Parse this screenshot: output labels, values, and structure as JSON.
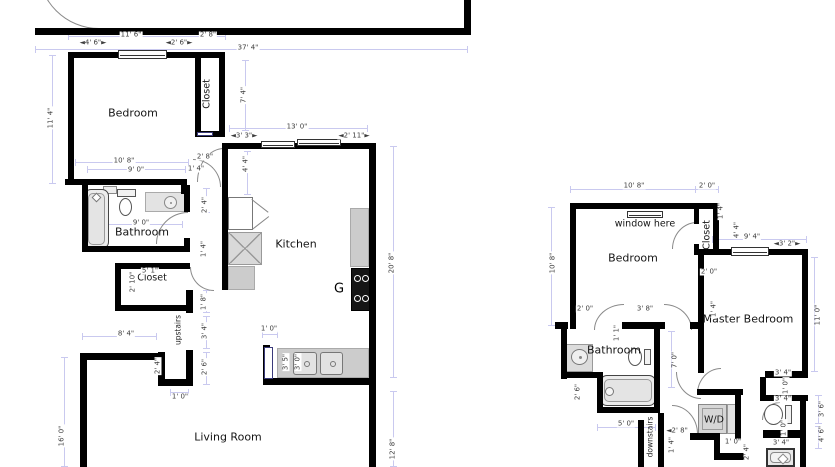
{
  "canvas": {
    "width": 835,
    "height": 467,
    "background": "#ffffff"
  },
  "colors": {
    "wall": "#000000",
    "dimension_line": "#c9c9ef",
    "dimension_text": "#3c3c3c",
    "room_text": "#151515",
    "fixture_fill": "#d9d9d9",
    "fixture_border": "#999999",
    "door_arc": "#8a8a8a",
    "door_jamb": "#3a3a7a"
  },
  "plans": [
    {
      "id": "unit-a-floorplan",
      "walls": [
        [
          35,
          28,
          436,
          7
        ],
        [
          464,
          0,
          7,
          30
        ],
        [
          68,
          52,
          157,
          6
        ],
        [
          68,
          52,
          6,
          133
        ],
        [
          65,
          179,
          122,
          6
        ],
        [
          181,
          185,
          6,
          9
        ],
        [
          195,
          52,
          6,
          85
        ],
        [
          219,
          52,
          6,
          85
        ],
        [
          195,
          131,
          30,
          6
        ],
        [
          82,
          185,
          6,
          67
        ],
        [
          82,
          246,
          108,
          6
        ],
        [
          184,
          185,
          6,
          27
        ],
        [
          184,
          238,
          6,
          14
        ],
        [
          115,
          263,
          75,
          6
        ],
        [
          115,
          263,
          6,
          48
        ],
        [
          115,
          305,
          75,
          6
        ],
        [
          186,
          290,
          7,
          23
        ],
        [
          186,
          350,
          7,
          36
        ],
        [
          158,
          379,
          35,
          7
        ],
        [
          158,
          352,
          7,
          33
        ],
        [
          80,
          353,
          80,
          7
        ],
        [
          80,
          353,
          7,
          114
        ],
        [
          369,
          143,
          7,
          324
        ],
        [
          222,
          143,
          154,
          6
        ],
        [
          222,
          143,
          6,
          147
        ],
        [
          263,
          378,
          113,
          7
        ],
        [
          263,
          345,
          7,
          40
        ]
      ],
      "windows": [
        [
          118,
          50,
          49,
          9
        ],
        [
          261,
          141,
          34,
          7
        ],
        [
          297,
          139,
          44,
          7
        ]
      ],
      "jambs": [
        [
          264,
          347,
          9,
          32
        ],
        [
          197,
          132,
          16,
          4
        ]
      ],
      "arcs": [
        [
          38,
          -32,
          60,
          60,
          "bl"
        ],
        [
          193,
          159,
          27,
          27,
          "tr"
        ],
        [
          197,
          148,
          26,
          33,
          "tl"
        ],
        [
          156,
          212,
          31,
          31,
          "tl"
        ],
        [
          190,
          267,
          23,
          23,
          "bl"
        ]
      ],
      "dimlines": [
        [
          68,
          36,
          225,
          36
        ],
        [
          35,
          49,
          467,
          49
        ],
        [
          52,
          55,
          52,
          183
        ],
        [
          245,
          60,
          245,
          130
        ],
        [
          229,
          128,
          367,
          128
        ],
        [
          247,
          151,
          247,
          194
        ],
        [
          75,
          162,
          188,
          162
        ],
        [
          87,
          169,
          185,
          169
        ],
        [
          393,
          146,
          393,
          377
        ],
        [
          393,
          391,
          393,
          466
        ],
        [
          64,
          357,
          64,
          466
        ],
        [
          82,
          336,
          156,
          336
        ],
        [
          92,
          224,
          182,
          224
        ],
        [
          206,
          188,
          206,
          212
        ],
        [
          206,
          290,
          206,
          312
        ],
        [
          206,
          316,
          206,
          348
        ],
        [
          206,
          352,
          206,
          384
        ],
        [
          161,
          354,
          161,
          382
        ],
        [
          170,
          392,
          188,
          392
        ],
        [
          262,
          334,
          277,
          334
        ]
      ],
      "fixtures": [
        {
          "type": "shelf",
          "x": 103,
          "y": 186,
          "w": 14,
          "h": 8
        },
        {
          "type": "tub-v",
          "x": 84,
          "y": 189,
          "w": 25,
          "h": 60
        },
        {
          "type": "toilet-down",
          "x": 116,
          "y": 189,
          "w": 23,
          "h": 29
        },
        {
          "type": "sink-counter",
          "x": 145,
          "y": 192,
          "w": 41,
          "h": 20
        },
        {
          "type": "fridge",
          "x": 228,
          "y": 197,
          "w": 25,
          "h": 33
        },
        {
          "type": "xbox",
          "x": 228,
          "y": 232,
          "w": 34,
          "h": 33
        },
        {
          "type": "counter",
          "x": 228,
          "y": 266,
          "w": 27,
          "h": 24
        },
        {
          "type": "counter",
          "x": 350,
          "y": 208,
          "w": 19,
          "h": 59
        },
        {
          "type": "stove",
          "x": 351,
          "y": 268,
          "w": 19,
          "h": 43
        },
        {
          "type": "counter",
          "x": 277,
          "y": 348,
          "w": 92,
          "h": 30
        },
        {
          "type": "dsink",
          "x": 293,
          "y": 351,
          "w": 50,
          "h": 25
        }
      ],
      "labels": [
        {
          "t": "Bedroom",
          "x": 133,
          "y": 113,
          "c": "room"
        },
        {
          "t": "Closet",
          "x": 207,
          "y": 94,
          "c": "rsm",
          "v": 1
        },
        {
          "t": "Bathroom",
          "x": 142,
          "y": 232,
          "c": "room"
        },
        {
          "t": "Closet",
          "x": 152,
          "y": 278,
          "c": "rsm"
        },
        {
          "t": "Kitchen",
          "x": 296,
          "y": 244,
          "c": "room"
        },
        {
          "t": "G",
          "x": 339,
          "y": 289,
          "c": "big"
        },
        {
          "t": "upstairs",
          "x": 178,
          "y": 330,
          "c": "tiny",
          "v": 1
        },
        {
          "t": "Living Room",
          "x": 228,
          "y": 437,
          "c": "room"
        },
        {
          "t": "11' 6\"",
          "x": 131,
          "y": 35,
          "c": "dim"
        },
        {
          "t": "2' 8\"",
          "x": 208,
          "y": 35,
          "c": "dim"
        },
        {
          "t": "◄4' 6\"►",
          "x": 93,
          "y": 43,
          "c": "dim"
        },
        {
          "t": "◄2' 6\"►",
          "x": 179,
          "y": 43,
          "c": "dim"
        },
        {
          "t": "37' 4\"",
          "x": 248,
          "y": 48,
          "c": "dim"
        },
        {
          "t": "11' 4\"",
          "x": 51,
          "y": 118,
          "c": "dim",
          "v": 1
        },
        {
          "t": "7' 4\"",
          "x": 244,
          "y": 95,
          "c": "dim",
          "v": 1
        },
        {
          "t": "13' 0\"",
          "x": 297,
          "y": 127,
          "c": "dim"
        },
        {
          "t": "◄3' 3\"►",
          "x": 244,
          "y": 136,
          "c": "dim"
        },
        {
          "t": "◄2' 11\"►",
          "x": 354,
          "y": 136,
          "c": "dim"
        },
        {
          "t": "4' 4\"",
          "x": 246,
          "y": 164,
          "c": "dim",
          "v": 1
        },
        {
          "t": "2' 8\"",
          "x": 205,
          "y": 157,
          "c": "dim"
        },
        {
          "t": "10' 8\"",
          "x": 124,
          "y": 161,
          "c": "dim"
        },
        {
          "t": "9' 0\"",
          "x": 136,
          "y": 170,
          "c": "dim"
        },
        {
          "t": "1' 4\"",
          "x": 196,
          "y": 169,
          "c": "dim"
        },
        {
          "t": "9' 0\"",
          "x": 141,
          "y": 223,
          "c": "dim"
        },
        {
          "t": "2' 4\"",
          "x": 205,
          "y": 205,
          "c": "dim",
          "v": 1
        },
        {
          "t": "1' 4\"",
          "x": 204,
          "y": 249,
          "c": "dim",
          "v": 1
        },
        {
          "t": "5' 1\"",
          "x": 150,
          "y": 271,
          "c": "dim"
        },
        {
          "t": "2' 10\"",
          "x": 133,
          "y": 282,
          "c": "dim",
          "v": 1
        },
        {
          "t": "1' 8\"",
          "x": 204,
          "y": 302,
          "c": "dim",
          "v": 1
        },
        {
          "t": "8' 4\"",
          "x": 126,
          "y": 334,
          "c": "dim"
        },
        {
          "t": "3' 4\"",
          "x": 205,
          "y": 331,
          "c": "dim",
          "v": 1
        },
        {
          "t": "2' 6\"",
          "x": 205,
          "y": 367,
          "c": "dim",
          "v": 1
        },
        {
          "t": "2' 4\"",
          "x": 158,
          "y": 366,
          "c": "dim",
          "v": 1
        },
        {
          "t": "1' 0\"",
          "x": 180,
          "y": 397,
          "c": "dim"
        },
        {
          "t": "1' 0\"",
          "x": 269,
          "y": 329,
          "c": "dim"
        },
        {
          "t": "3' 5\"",
          "x": 286,
          "y": 362,
          "c": "dim",
          "v": 1
        },
        {
          "t": "3' 0\"",
          "x": 298,
          "y": 362,
          "c": "dim",
          "v": 1
        },
        {
          "t": "16' 0\"",
          "x": 62,
          "y": 436,
          "c": "dim",
          "v": 1
        },
        {
          "t": "20' 8\"",
          "x": 392,
          "y": 263,
          "c": "dim",
          "v": 1
        },
        {
          "t": "12' 8\"",
          "x": 393,
          "y": 449,
          "c": "dim",
          "v": 1
        }
      ]
    },
    {
      "id": "unit-b-floorplan",
      "walls": [
        [
          570,
          203,
          148,
          6
        ],
        [
          570,
          203,
          6,
          126
        ],
        [
          694,
          209,
          5,
          15
        ],
        [
          694,
          244,
          5,
          11
        ],
        [
          713,
          203,
          6,
          51
        ],
        [
          694,
          249,
          114,
          6
        ],
        [
          698,
          255,
          6,
          118
        ],
        [
          802,
          255,
          6,
          122
        ],
        [
          765,
          371,
          43,
          7
        ],
        [
          760,
          377,
          6,
          24
        ],
        [
          760,
          395,
          48,
          6
        ],
        [
          800,
          401,
          6,
          66
        ],
        [
          763,
          430,
          43,
          8
        ],
        [
          555,
          322,
          13,
          7
        ],
        [
          622,
          322,
          43,
          7
        ],
        [
          690,
          322,
          9,
          7
        ],
        [
          654,
          329,
          6,
          84
        ],
        [
          561,
          329,
          6,
          50
        ],
        [
          561,
          372,
          42,
          6
        ],
        [
          597,
          378,
          6,
          35
        ],
        [
          597,
          407,
          63,
          6
        ],
        [
          658,
          413,
          6,
          54
        ],
        [
          638,
          420,
          6,
          47
        ],
        [
          697,
          389,
          46,
          6
        ],
        [
          735,
          389,
          6,
          51
        ],
        [
          690,
          433,
          30,
          7
        ],
        [
          714,
          440,
          6,
          20
        ],
        [
          714,
          453,
          30,
          7
        ]
      ],
      "windows": [
        [
          627,
          211,
          36,
          7
        ],
        [
          731,
          247,
          38,
          9
        ]
      ],
      "jambs": [],
      "arcs": [
        [
          672,
          222,
          24,
          26,
          "tl"
        ],
        [
          594,
          304,
          29,
          25,
          "tl"
        ],
        [
          664,
          304,
          27,
          25,
          "tr"
        ],
        [
          676,
          372,
          24,
          26,
          "bl"
        ],
        [
          697,
          368,
          23,
          25,
          "tl"
        ],
        [
          672,
          405,
          25,
          28,
          "tr"
        ],
        [
          762,
          402,
          17,
          17,
          "tl"
        ]
      ],
      "dimlines": [
        [
          570,
          189,
          695,
          189
        ],
        [
          695,
          189,
          718,
          189
        ],
        [
          551,
          207,
          551,
          325
        ],
        [
          712,
          239,
          806,
          239
        ],
        [
          814,
          257,
          814,
          371
        ],
        [
          671,
          331,
          671,
          387
        ],
        [
          597,
          427,
          655,
          427
        ],
        [
          818,
          395,
          818,
          423
        ],
        [
          818,
          426,
          818,
          448
        ]
      ],
      "fixtures": [
        {
          "type": "vanity",
          "x": 566,
          "y": 344,
          "w": 27,
          "h": 28
        },
        {
          "type": "toilet-left",
          "x": 628,
          "y": 348,
          "w": 25,
          "h": 20
        },
        {
          "type": "tub-h",
          "x": 600,
          "y": 375,
          "w": 56,
          "h": 31
        },
        {
          "type": "wd-main",
          "x": 698,
          "y": 404,
          "w": 29,
          "h": 30
        },
        {
          "type": "wd-panel",
          "x": 727,
          "y": 404,
          "w": 9,
          "h": 30
        },
        {
          "type": "toilet-left",
          "x": 764,
          "y": 404,
          "w": 30,
          "h": 23
        },
        {
          "type": "sink-sq",
          "x": 766,
          "y": 448,
          "w": 29,
          "h": 19
        }
      ],
      "labels": [
        {
          "t": "window here",
          "x": 645,
          "y": 224,
          "c": "note"
        },
        {
          "t": "Bedroom",
          "x": 633,
          "y": 258,
          "c": "room"
        },
        {
          "t": "Closet",
          "x": 707,
          "y": 235,
          "c": "rsm",
          "v": 1
        },
        {
          "t": "Master Bedroom",
          "x": 748,
          "y": 319,
          "c": "room"
        },
        {
          "t": "Bathroom",
          "x": 614,
          "y": 350,
          "c": "room"
        },
        {
          "t": "W/D",
          "x": 714,
          "y": 420,
          "c": "rsm"
        },
        {
          "t": "downstairs",
          "x": 650,
          "y": 437,
          "c": "tiny",
          "v": 1
        },
        {
          "t": "10' 8\"",
          "x": 634,
          "y": 186,
          "c": "dim"
        },
        {
          "t": "2' 0\"",
          "x": 707,
          "y": 186,
          "c": "dim"
        },
        {
          "t": "1' 4\"",
          "x": 721,
          "y": 211,
          "c": "dim",
          "v": 1
        },
        {
          "t": "4' 4\"",
          "x": 737,
          "y": 230,
          "c": "dim",
          "v": 1
        },
        {
          "t": "9' 4\"",
          "x": 752,
          "y": 237,
          "c": "dim"
        },
        {
          "t": "◄3' 2\"►",
          "x": 787,
          "y": 244,
          "c": "dim"
        },
        {
          "t": "2' 0\"",
          "x": 709,
          "y": 272,
          "c": "dim"
        },
        {
          "t": "1' 4\"",
          "x": 714,
          "y": 309,
          "c": "dim",
          "v": 1
        },
        {
          "t": "11' 0\"",
          "x": 818,
          "y": 315,
          "c": "dim",
          "v": 1
        },
        {
          "t": "10' 8\"",
          "x": 553,
          "y": 263,
          "c": "dim",
          "v": 1
        },
        {
          "t": "2' 0\"",
          "x": 585,
          "y": 309,
          "c": "dim"
        },
        {
          "t": "3' 8\"",
          "x": 645,
          "y": 309,
          "c": "dim"
        },
        {
          "t": "1' 1\"",
          "x": 617,
          "y": 333,
          "c": "dim",
          "v": 1
        },
        {
          "t": "7' 0\"",
          "x": 675,
          "y": 360,
          "c": "dim",
          "v": 1
        },
        {
          "t": "2' 6\"",
          "x": 578,
          "y": 392,
          "c": "dim",
          "v": 1
        },
        {
          "t": "5' 0\"",
          "x": 626,
          "y": 424,
          "c": "dim"
        },
        {
          "t": "◄2' 8\"",
          "x": 677,
          "y": 431,
          "c": "dim"
        },
        {
          "t": "1' 4\"",
          "x": 672,
          "y": 445,
          "c": "dim",
          "v": 1
        },
        {
          "t": "1' 0\"",
          "x": 733,
          "y": 442,
          "c": "dim"
        },
        {
          "t": "2' 4\"",
          "x": 747,
          "y": 452,
          "c": "dim",
          "v": 1
        },
        {
          "t": "3' 4\"",
          "x": 783,
          "y": 373,
          "c": "dim"
        },
        {
          "t": "1' 0\"",
          "x": 786,
          "y": 386,
          "c": "dim",
          "v": 1
        },
        {
          "t": "3' 4\"",
          "x": 783,
          "y": 399,
          "c": "dim"
        },
        {
          "t": "1' 0\"",
          "x": 784,
          "y": 428,
          "c": "dim",
          "v": 1
        },
        {
          "t": "3' 4\"",
          "x": 781,
          "y": 443,
          "c": "dim"
        },
        {
          "t": "3' 6\"",
          "x": 822,
          "y": 409,
          "c": "dim",
          "v": 1
        },
        {
          "t": "4' 6\"",
          "x": 822,
          "y": 434,
          "c": "dim",
          "v": 1
        }
      ]
    }
  ]
}
